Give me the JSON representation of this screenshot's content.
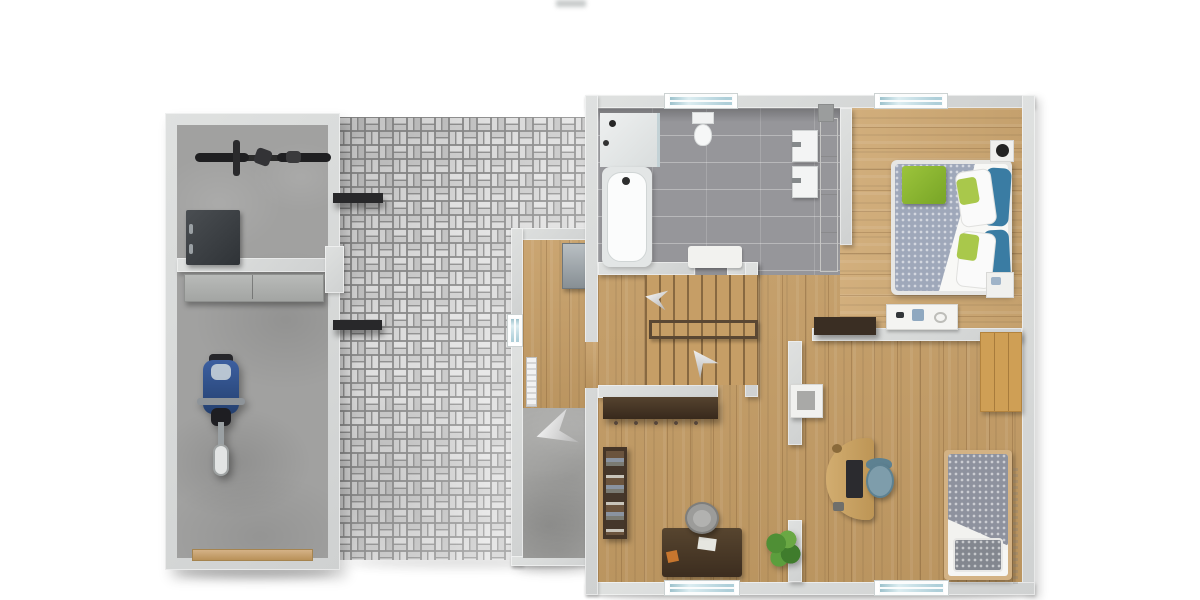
{
  "meta": {
    "description": "Top-down 3D rendered floor plan: house upper floor with bathroom, two bedrooms, study, stair landing, entry hall, adjoining garage and basket-weave paved courtyard",
    "canvas": {
      "width": 1200,
      "height": 600
    },
    "background": "#ffffff"
  },
  "palette": {
    "wall": "#d6d8d7",
    "wall_edge": "#bcbebe",
    "wood": "#c69e66",
    "wood_bedroom": "#cfa973",
    "tile_gray": "#96969a",
    "concrete": "#a1a1a0",
    "paver_light": "#e6e6e6",
    "paver_mid": "#cfcfcf",
    "paver_joint": "#8a8a8a",
    "duvet_gray": "#9fa8ba",
    "throw_green": "#8cb832",
    "cushion_green": "#a9c84b",
    "pillow_teal": "#3a7ca3",
    "paisley_gray": "#8e929e",
    "chair_teal": "#7e9dab",
    "chair_gray": "#9c9c9a",
    "dark_wood": "#45362a",
    "desk_dark": "#4a3a2c",
    "desk_tan": "#c7a266",
    "bed_frame_tan": "#d3b284",
    "wardrobe_panel": "#cf9f55",
    "plant_green": "#55953a",
    "motorcycle_blue": "#31528f",
    "steel_cabinet": "#a5adb2",
    "window_glass": "#aecfd9",
    "garage_door_tan": "#c9a97c",
    "railing_brown": "#5a4733"
  },
  "areas": {
    "garage": {
      "name": "garage",
      "floor": "concrete",
      "objects": [
        "bicycle",
        "workbench",
        "wall-shelf",
        "motorcycle",
        "garage-door",
        "awning-shelf",
        "awning-shelf"
      ]
    },
    "courtyard": {
      "name": "paved-courtyard",
      "floor": "basket-weave-pavers",
      "objects": []
    },
    "entry": {
      "name": "entry-hall",
      "floor": "wood-and-concrete",
      "objects": [
        "steel-wardrobe",
        "radiator",
        "window",
        "direction-arrow"
      ]
    },
    "bathroom": {
      "name": "bathroom",
      "floor": "gray-tile",
      "objects": [
        "shower",
        "bathtub",
        "wall-hung-toilet",
        "sink",
        "sink",
        "tall-cabinet",
        "bath-mat",
        "window",
        "service-shaft"
      ]
    },
    "bedroom": {
      "name": "master-bedroom",
      "floor": "wood",
      "objects": [
        "double-bed",
        "green-throw",
        "teal-pillows",
        "green-cushions",
        "nightstand-with-lamp",
        "nightstand",
        "dresser-with-jewelry",
        "window"
      ]
    },
    "landing": {
      "name": "stair-landing",
      "floor": "wood",
      "objects": [
        "staircase",
        "stair-opening-railing",
        "direction-arrow",
        "direction-arrow"
      ]
    },
    "study": {
      "name": "study",
      "floor": "wood",
      "objects": [
        "sideboard-with-hooks",
        "bookshelf",
        "desk",
        "desk-chair",
        "potted-plant",
        "window"
      ]
    },
    "second_bedroom": {
      "name": "second-bedroom",
      "floor": "wood",
      "objects": [
        "curved-desk",
        "office-chair",
        "laptop",
        "single-bed-paisley",
        "wardrobe-panel",
        "wall-cabinet",
        "floating-shelf",
        "display-tray",
        "window"
      ]
    }
  }
}
